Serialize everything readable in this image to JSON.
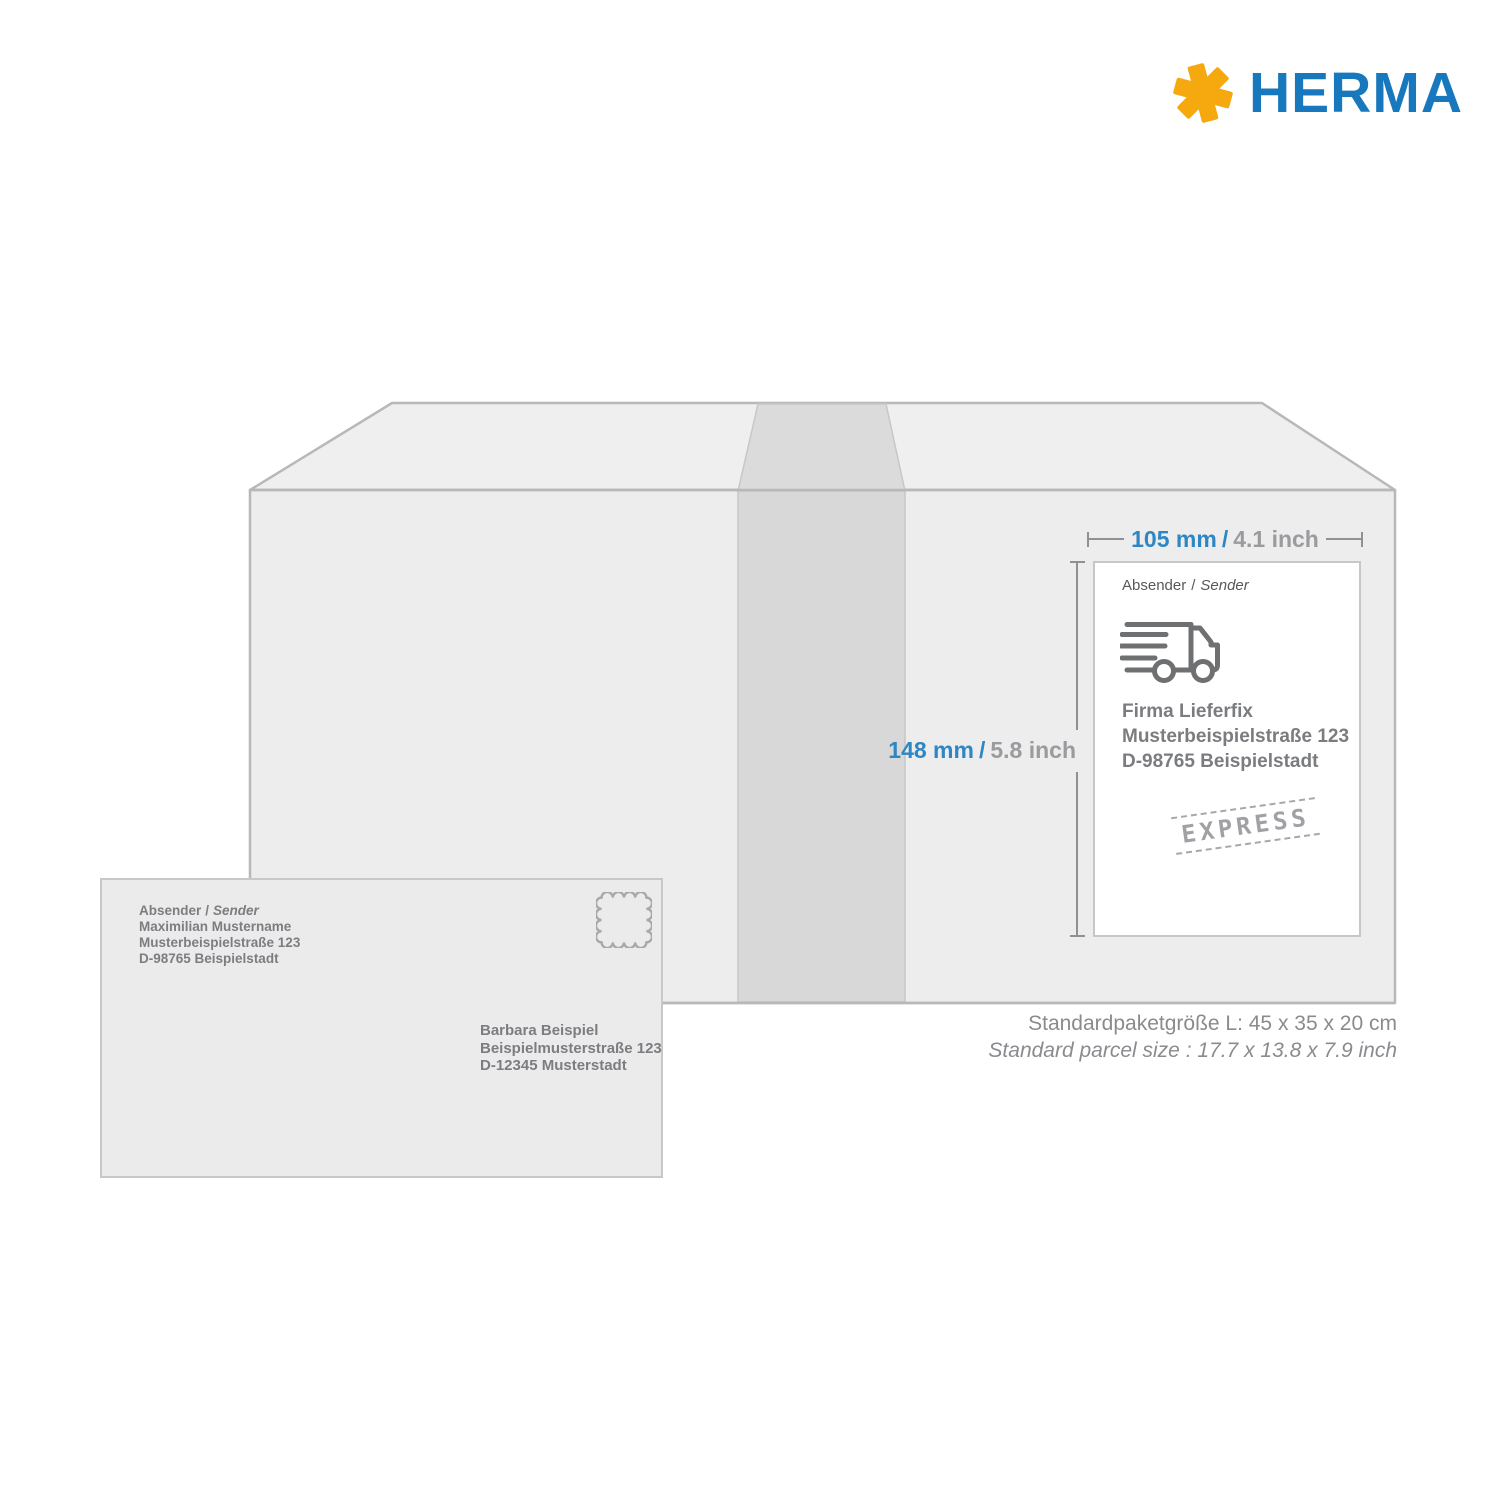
{
  "brand": {
    "name": "HERMA"
  },
  "icons": {
    "logo": "herma-asterisk-icon",
    "truck": "delivery-truck-icon",
    "postage_stamp": "postage-stamp-icon"
  },
  "colors": {
    "brand_blue": "#1878BE",
    "brand_yellow": "#F6A90F",
    "dimension_blue": "#2E86C3",
    "dimension_gray": "#9A9B9E",
    "text_gray": "#7C7D80",
    "box_fill": "#EDEDEE",
    "tape_fill": "#D8D8D9",
    "envelope_fill": "#EBEBEC"
  },
  "dimensions": {
    "width": {
      "metric": "105 mm",
      "separator": "/",
      "imperial": "4.1 inch"
    },
    "height": {
      "metric": "148 mm",
      "separator": "/",
      "imperial": "5.8 inch"
    }
  },
  "shipping_label": {
    "heading_de": "Absender",
    "heading_sep": "/",
    "heading_en": "Sender",
    "address_lines": [
      "Firma Lieferfix",
      "Musterbeispielstraße 123",
      "D-98765 Beispielstadt"
    ],
    "stamp_text": "EXPRESS"
  },
  "envelope": {
    "heading_de": "Absender",
    "heading_sep": "/",
    "heading_en": "Sender",
    "sender_lines": [
      "Maximilian Mustername",
      "Musterbeispielstraße 123",
      "D-98765 Beispielstadt"
    ],
    "recipient_lines": [
      "Barbara Beispiel",
      "Beispielmusterstraße 123",
      "D-12345 Musterstadt"
    ]
  },
  "parcel_info": {
    "line_de": "Standardpaketgröße L: 45 x 35 x 20 cm",
    "line_en": "Standard parcel size : 17.7 x 13.8 x 7.9 inch"
  }
}
